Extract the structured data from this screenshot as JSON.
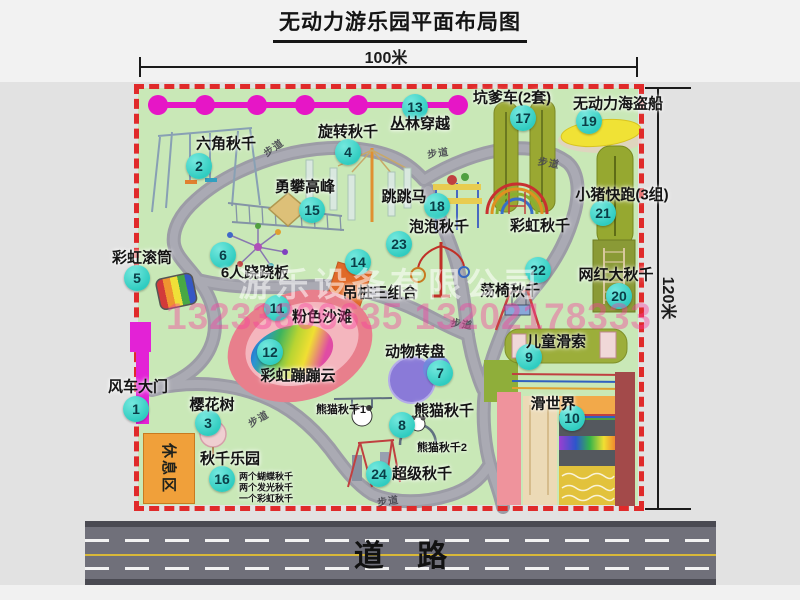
{
  "title": "无动力游乐园平面布局图",
  "dimensions": {
    "top": "100米",
    "right": "120米"
  },
  "road": {
    "label": "道    路"
  },
  "watermark": {
    "company": "游乐设备有限公司",
    "phone": "13233806635 13202178333"
  },
  "rest_area": "休息区",
  "colors": {
    "badge": "#2fccc0",
    "border_red": "#e02a2a",
    "map_bg": "#c9e8b7",
    "zipline_magenta": "#e616c6",
    "accent_orange": "#f0a03a",
    "road_asphalt": "#70707a",
    "road_center_yellow": "#d8b838"
  },
  "map": {
    "attractions": [
      {
        "num": "1",
        "name": "风车大门",
        "badge": [
          136,
          409
        ],
        "label": [
          138,
          386
        ]
      },
      {
        "num": "2",
        "name": "六角秋千",
        "badge": [
          199,
          166
        ],
        "label": [
          226,
          143
        ]
      },
      {
        "num": "3",
        "name": "樱花树",
        "badge": [
          208,
          423
        ],
        "label": [
          212,
          404
        ]
      },
      {
        "num": "4",
        "name": "旋转秋千",
        "badge": [
          348,
          152
        ],
        "label": [
          348,
          131
        ]
      },
      {
        "num": "5",
        "name": "彩虹滚筒",
        "badge": [
          137,
          278
        ],
        "label": [
          142,
          257
        ]
      },
      {
        "num": "6",
        "name": "6人跷跷板",
        "badge": [
          223,
          255
        ],
        "label": [
          255,
          272
        ]
      },
      {
        "num": "7",
        "name": "动物转盘",
        "badge": [
          440,
          373
        ],
        "label": [
          415,
          351
        ]
      },
      {
        "num": "8",
        "name": "熊猫秋千",
        "badge": [
          402,
          425
        ],
        "label": [
          444,
          410
        ]
      },
      {
        "num": "9",
        "name": "儿童滑索",
        "badge": [
          529,
          357
        ],
        "label": [
          556,
          341
        ]
      },
      {
        "num": "10",
        "name": "滑世界",
        "badge": [
          572,
          418
        ],
        "label": [
          553,
          403
        ]
      },
      {
        "num": "11",
        "name": "粉色沙滩",
        "badge": [
          277,
          308
        ],
        "label": [
          322,
          316
        ]
      },
      {
        "num": "12",
        "name": "彩虹蹦蹦云",
        "badge": [
          270,
          352
        ],
        "label": [
          298,
          375
        ]
      },
      {
        "num": "13",
        "name": "丛林穿越",
        "badge": [
          415,
          107
        ],
        "label": [
          420,
          123
        ]
      },
      {
        "num": "14",
        "name": "吊桩三组合",
        "badge": [
          358,
          262
        ],
        "label": [
          380,
          292
        ]
      },
      {
        "num": "15",
        "name": "勇攀高峰",
        "badge": [
          312,
          210
        ],
        "label": [
          305,
          186
        ]
      },
      {
        "num": "16",
        "name": "秋千乐园",
        "badge": [
          222,
          479
        ],
        "label": [
          230,
          458
        ]
      },
      {
        "num": "17",
        "name": "坑爹车(2套)",
        "badge": [
          523,
          118
        ],
        "label": [
          512,
          97
        ]
      },
      {
        "num": "18",
        "name": "跳跳马",
        "badge": [
          437,
          206
        ],
        "label": [
          404,
          196
        ]
      },
      {
        "num": "19",
        "name": "无动力海盗船",
        "badge": [
          589,
          121
        ],
        "label": [
          618,
          103
        ]
      },
      {
        "num": "20",
        "name": "网红大秋千",
        "badge": [
          619,
          296
        ],
        "label": [
          616,
          274
        ]
      },
      {
        "num": "21",
        "name": "小猪快跑(3组)",
        "badge": [
          603,
          213
        ],
        "label": [
          622,
          194
        ]
      },
      {
        "num": "22",
        "name": "荡椅秋千",
        "badge": [
          538,
          270
        ],
        "label": [
          510,
          290
        ]
      },
      {
        "num": "23",
        "name": "泡泡秋千",
        "badge": [
          399,
          244
        ],
        "label": [
          439,
          226
        ]
      },
      {
        "num": "24",
        "name": "超级秋千",
        "badge": [
          379,
          474
        ],
        "label": [
          422,
          473
        ]
      }
    ],
    "extra_labels": [
      {
        "text": "彩虹秋千",
        "x": 540,
        "y": 225,
        "size": 15
      },
      {
        "text": "熊猫秋千1",
        "x": 341,
        "y": 409,
        "size": 11
      },
      {
        "text": "熊猫秋千2",
        "x": 442,
        "y": 447,
        "size": 11
      },
      {
        "text": "两个蝴蝶秋千",
        "x": 266,
        "y": 476,
        "size": 9
      },
      {
        "text": "两个发光秋千",
        "x": 266,
        "y": 487,
        "size": 9
      },
      {
        "text": "一个彩虹秋千",
        "x": 266,
        "y": 498,
        "size": 9
      }
    ],
    "path_labels": [
      {
        "text": "步道",
        "x": 273,
        "y": 147,
        "rot": -35
      },
      {
        "text": "步道",
        "x": 438,
        "y": 152,
        "rot": -8
      },
      {
        "text": "步道",
        "x": 549,
        "y": 162,
        "rot": 10
      },
      {
        "text": "步道",
        "x": 462,
        "y": 323,
        "rot": 8
      },
      {
        "text": "步道",
        "x": 258,
        "y": 418,
        "rot": -30
      },
      {
        "text": "步道",
        "x": 388,
        "y": 500,
        "rot": -8
      }
    ]
  }
}
